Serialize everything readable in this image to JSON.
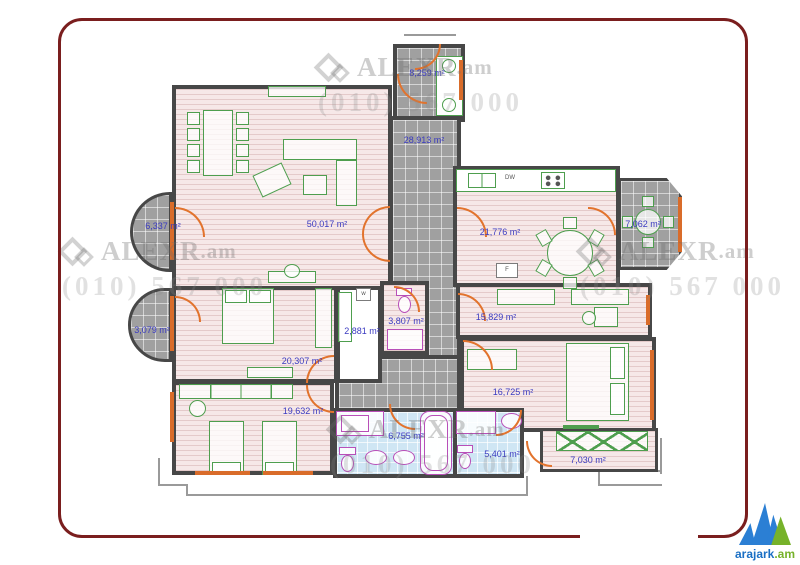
{
  "plan": {
    "rooms": {
      "living": {
        "area": "50,017 m²"
      },
      "entry": {
        "area": "8,259 m²"
      },
      "hall": {
        "area": "28,913 m²"
      },
      "kitchen": {
        "area": "21,776 m²"
      },
      "balcony_top_left": {
        "area": "6,337 m²"
      },
      "balcony_top_right": {
        "area": "7,062 m²"
      },
      "balcony_left": {
        "area": "3,079 m²"
      },
      "bedroom1": {
        "area": "20,307 m²"
      },
      "closet": {
        "area": "2,881 m²"
      },
      "wc": {
        "area": "3,807 m²"
      },
      "study": {
        "area": "15,829 m²"
      },
      "bedroom2": {
        "area": "19,632 m²"
      },
      "bedroom3": {
        "area": "16,725 m²"
      },
      "bathroom1": {
        "area": "6,755 m²"
      },
      "bathroom2": {
        "area": "5,401 m²"
      },
      "balcony_bottom": {
        "area": "7,030 m²"
      }
    },
    "appliances": {
      "dishwasher": "DW",
      "fridge": "F",
      "washer": "w"
    },
    "colors": {
      "wall": "#474747",
      "door": "#e2732d",
      "furniture": "#4e9e4e",
      "fixture": "#b84fb8",
      "label": "#3a3ac0",
      "floor_pink": "#f6e8e8",
      "tile_gray": "#a0a0a0",
      "tile_blue": "#cfe6f4",
      "frame": "#7a1e1e"
    }
  },
  "watermark": {
    "brand": "ALEXR",
    "tld": ".am",
    "phone": "(010) 567 000"
  },
  "logo": {
    "name": "arajark",
    "tld": ".am",
    "blue": "#1a6fc4",
    "green": "#76b22a"
  }
}
